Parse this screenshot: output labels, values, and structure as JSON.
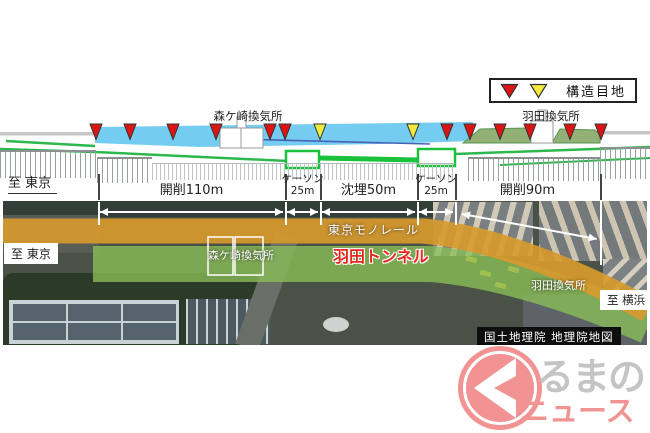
{
  "colors": {
    "marker_red": "#dd1414",
    "marker_yellow": "#f2ea3d",
    "marker_outline": "#333333",
    "water": "#74cdf0",
    "structure_green": "#2db84d",
    "immersed_green": "#19c23a",
    "monorail_band": "#d79a2e",
    "tunnel_band": "#8abf57",
    "tunnel_text": "#e8281e",
    "logo_pink": "#f18585",
    "logo_gray": "#bcbdbf"
  },
  "legend": {
    "title": "構造目地"
  },
  "cross_section": {
    "to_tokyo": "至 東京",
    "morigasaki_label": "森ケ崎換気所",
    "haneda_label": "羽田換気所",
    "markers": [
      {
        "x": 96,
        "color": "red"
      },
      {
        "x": 130,
        "color": "red"
      },
      {
        "x": 173,
        "color": "red"
      },
      {
        "x": 216,
        "color": "red"
      },
      {
        "x": 270,
        "color": "red"
      },
      {
        "x": 285,
        "color": "red"
      },
      {
        "x": 320,
        "color": "yellow"
      },
      {
        "x": 413,
        "color": "yellow"
      },
      {
        "x": 447,
        "color": "red"
      },
      {
        "x": 470,
        "color": "red"
      },
      {
        "x": 500,
        "color": "red"
      },
      {
        "x": 530,
        "color": "red"
      },
      {
        "x": 570,
        "color": "red"
      },
      {
        "x": 601,
        "color": "red"
      }
    ],
    "dimensions": [
      {
        "label": "開削110m",
        "x1": 98,
        "x2": 285
      },
      {
        "label": "ケーソン",
        "label2": "25m",
        "x1": 285,
        "x2": 320
      },
      {
        "label": "沈埋50m",
        "x1": 320,
        "x2": 417
      },
      {
        "label": "ケーソン",
        "label2": "25m",
        "x1": 417,
        "x2": 455
      },
      {
        "label": "開削90m",
        "x1": 455,
        "x2": 600,
        "slant": true
      }
    ]
  },
  "map": {
    "monorail_label": "東京モノレール",
    "tunnel_label": "羽田トンネル",
    "morigasaki_label": "森ケ崎換気所",
    "haneda_label": "羽田換気所",
    "to_tokyo": "至 東京",
    "to_yokohama": "至 横浜",
    "credit": "国土地理院 地理院地図"
  },
  "watermark": {
    "logo_mark": "く",
    "line1": "るまの",
    "line2": "ニュース"
  }
}
